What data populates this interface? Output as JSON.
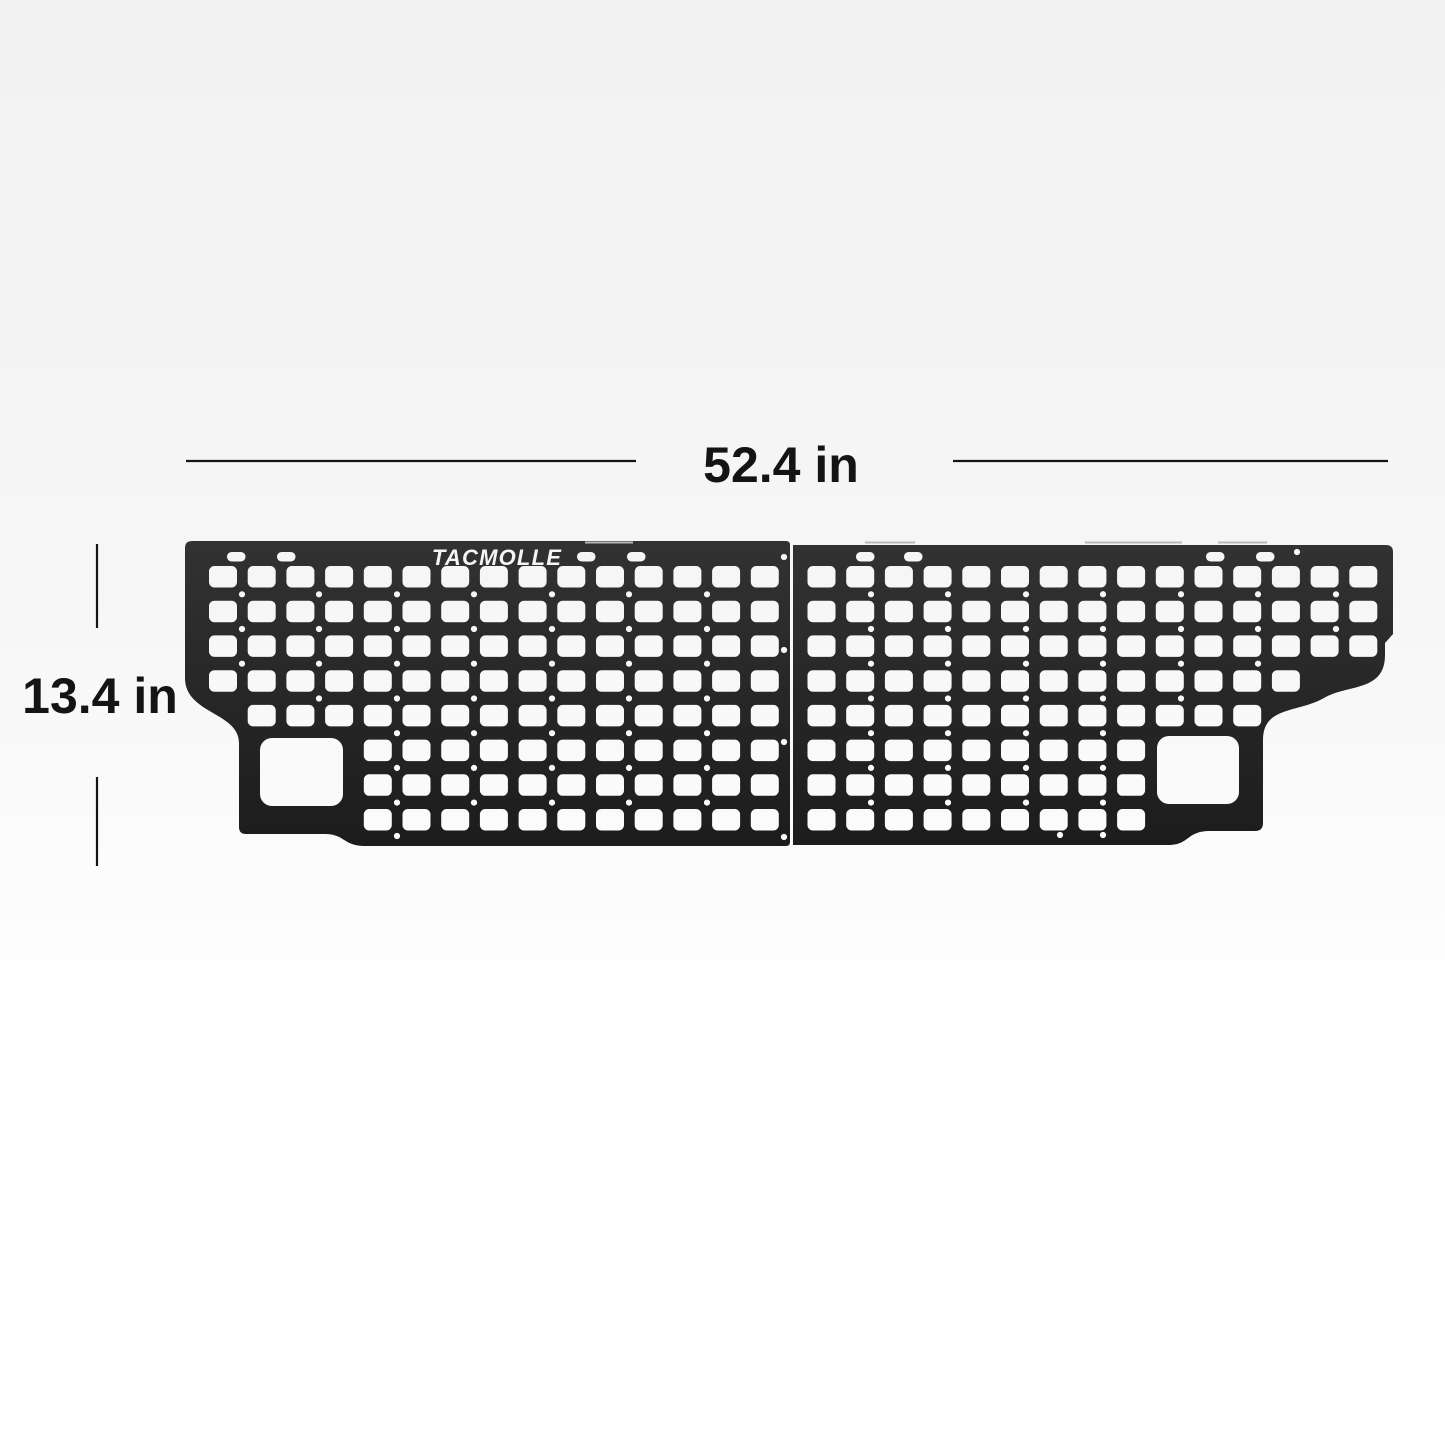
{
  "page": {
    "background_top": "#f2f2f2",
    "background_mid": "#f6f6f6",
    "background_bottom": "#ffffff"
  },
  "dimensions": {
    "width_label": "52.4 in",
    "height_label": "13.4 in",
    "color": "#141414",
    "line_width": 2.2,
    "font_size": 50,
    "width_dim": {
      "label_x": 781,
      "label_y": 482,
      "line_y": 461,
      "seg_left": [
        186,
        636
      ],
      "seg_right": [
        953,
        1388
      ]
    },
    "height_dim": {
      "label_x": 100,
      "label_y": 713,
      "line_x": 97,
      "seg_top": [
        544,
        628
      ],
      "seg_bottom": [
        777,
        866
      ]
    }
  },
  "panel": {
    "brand": "TACMOLLE",
    "logo": {
      "x": 497,
      "y": 565,
      "font_size": 22,
      "letter_spacing": 1.2,
      "color": "#f5f5f5"
    },
    "color_top": "#323232",
    "color_bottom": "#1c1c1c",
    "grid": {
      "slot_w": 28,
      "slot_h": 21.5,
      "slot_r": 5.5,
      "col_pitch": 38.7,
      "row_y0": 566,
      "row_pitch": 34.72,
      "pill_y": 552,
      "pill_w": 18.5,
      "pill_h": 9.5,
      "pill_r": 4.6,
      "dot_r": 3.1,
      "gap_y0": 594.3,
      "gap_pitch": 34.72,
      "cutout_r": 12
    },
    "halves": [
      {
        "name": "left",
        "outline": "M192,541 L786,541 Q790,541 790,545 L790,842 Q790,846 786,846 L366,846 C342,846 346,834 324,834 L246,834 Q239,834 239,827 L239,743 C239,712 185,714 185,678 L185,548 Q185,541 192,541 Z",
        "col_x0": 209,
        "slot_rows": [
          [
            0,
            14
          ],
          [
            0,
            14
          ],
          [
            0,
            14
          ],
          [
            0,
            14
          ],
          [
            1,
            14
          ],
          [
            4,
            14
          ],
          [
            4,
            14
          ],
          [
            4,
            14
          ]
        ],
        "pills": [
          227,
          277,
          577,
          627
        ],
        "cutout": {
          "x": 260,
          "y": 738,
          "w": 83,
          "h": 68
        },
        "dot_cols": [
          {
            "x": 242,
            "g": [
              0,
              2
            ]
          },
          {
            "x": 319,
            "g": [
              0,
              3
            ]
          },
          {
            "x": 397,
            "g": [
              0,
              6
            ]
          },
          {
            "x": 474,
            "g": [
              0,
              6
            ]
          },
          {
            "x": 552,
            "g": [
              0,
              6
            ]
          },
          {
            "x": 629,
            "g": [
              0,
              6
            ]
          },
          {
            "x": 707,
            "g": [
              0,
              6
            ]
          }
        ],
        "extra_dots": [
          [
            397,
            836
          ],
          [
            784,
            557
          ],
          [
            784,
            650
          ],
          [
            784,
            742
          ],
          [
            784,
            837
          ]
        ]
      },
      {
        "name": "right",
        "outline": "M793,545 L1386,545 Q1393,545 1393,552 L1393,634 L1385,643 L1385,655 C1385,692 1348,684 1324,698 C1298,713 1263,706 1263,740 L1263,823 Q1263,831 1255,831 L1210,831 C1186,831 1190,845 1168,845 L793,845 Z",
        "col_x0": 807.5,
        "slot_rows": [
          [
            0,
            14
          ],
          [
            0,
            14
          ],
          [
            0,
            14
          ],
          [
            0,
            12
          ],
          [
            0,
            11
          ],
          [
            0,
            8
          ],
          [
            0,
            8
          ],
          [
            0,
            8
          ]
        ],
        "pills": [
          856,
          904,
          1206,
          1256
        ],
        "cutout": {
          "x": 1157,
          "y": 736,
          "w": 82,
          "h": 68
        },
        "dot_cols": [
          {
            "x": 871,
            "g": [
              0,
              6
            ]
          },
          {
            "x": 948,
            "g": [
              0,
              6
            ]
          },
          {
            "x": 1026,
            "g": [
              0,
              6
            ]
          },
          {
            "x": 1103,
            "g": [
              0,
              6
            ]
          },
          {
            "x": 1181,
            "g": [
              0,
              3
            ]
          },
          {
            "x": 1258,
            "g": [
              0,
              2
            ]
          },
          {
            "x": 1336,
            "g": [
              0,
              1
            ]
          }
        ],
        "extra_dots": [
          [
            1060,
            835
          ],
          [
            1103,
            835
          ],
          [
            1297,
            552
          ]
        ]
      }
    ],
    "lip_marks": {
      "y": 542.5,
      "color": "#b9b9b9",
      "width": 2,
      "segments": [
        [
          585,
          633
        ],
        [
          865,
          915
        ],
        [
          1085,
          1182
        ],
        [
          1218,
          1267
        ]
      ]
    }
  }
}
